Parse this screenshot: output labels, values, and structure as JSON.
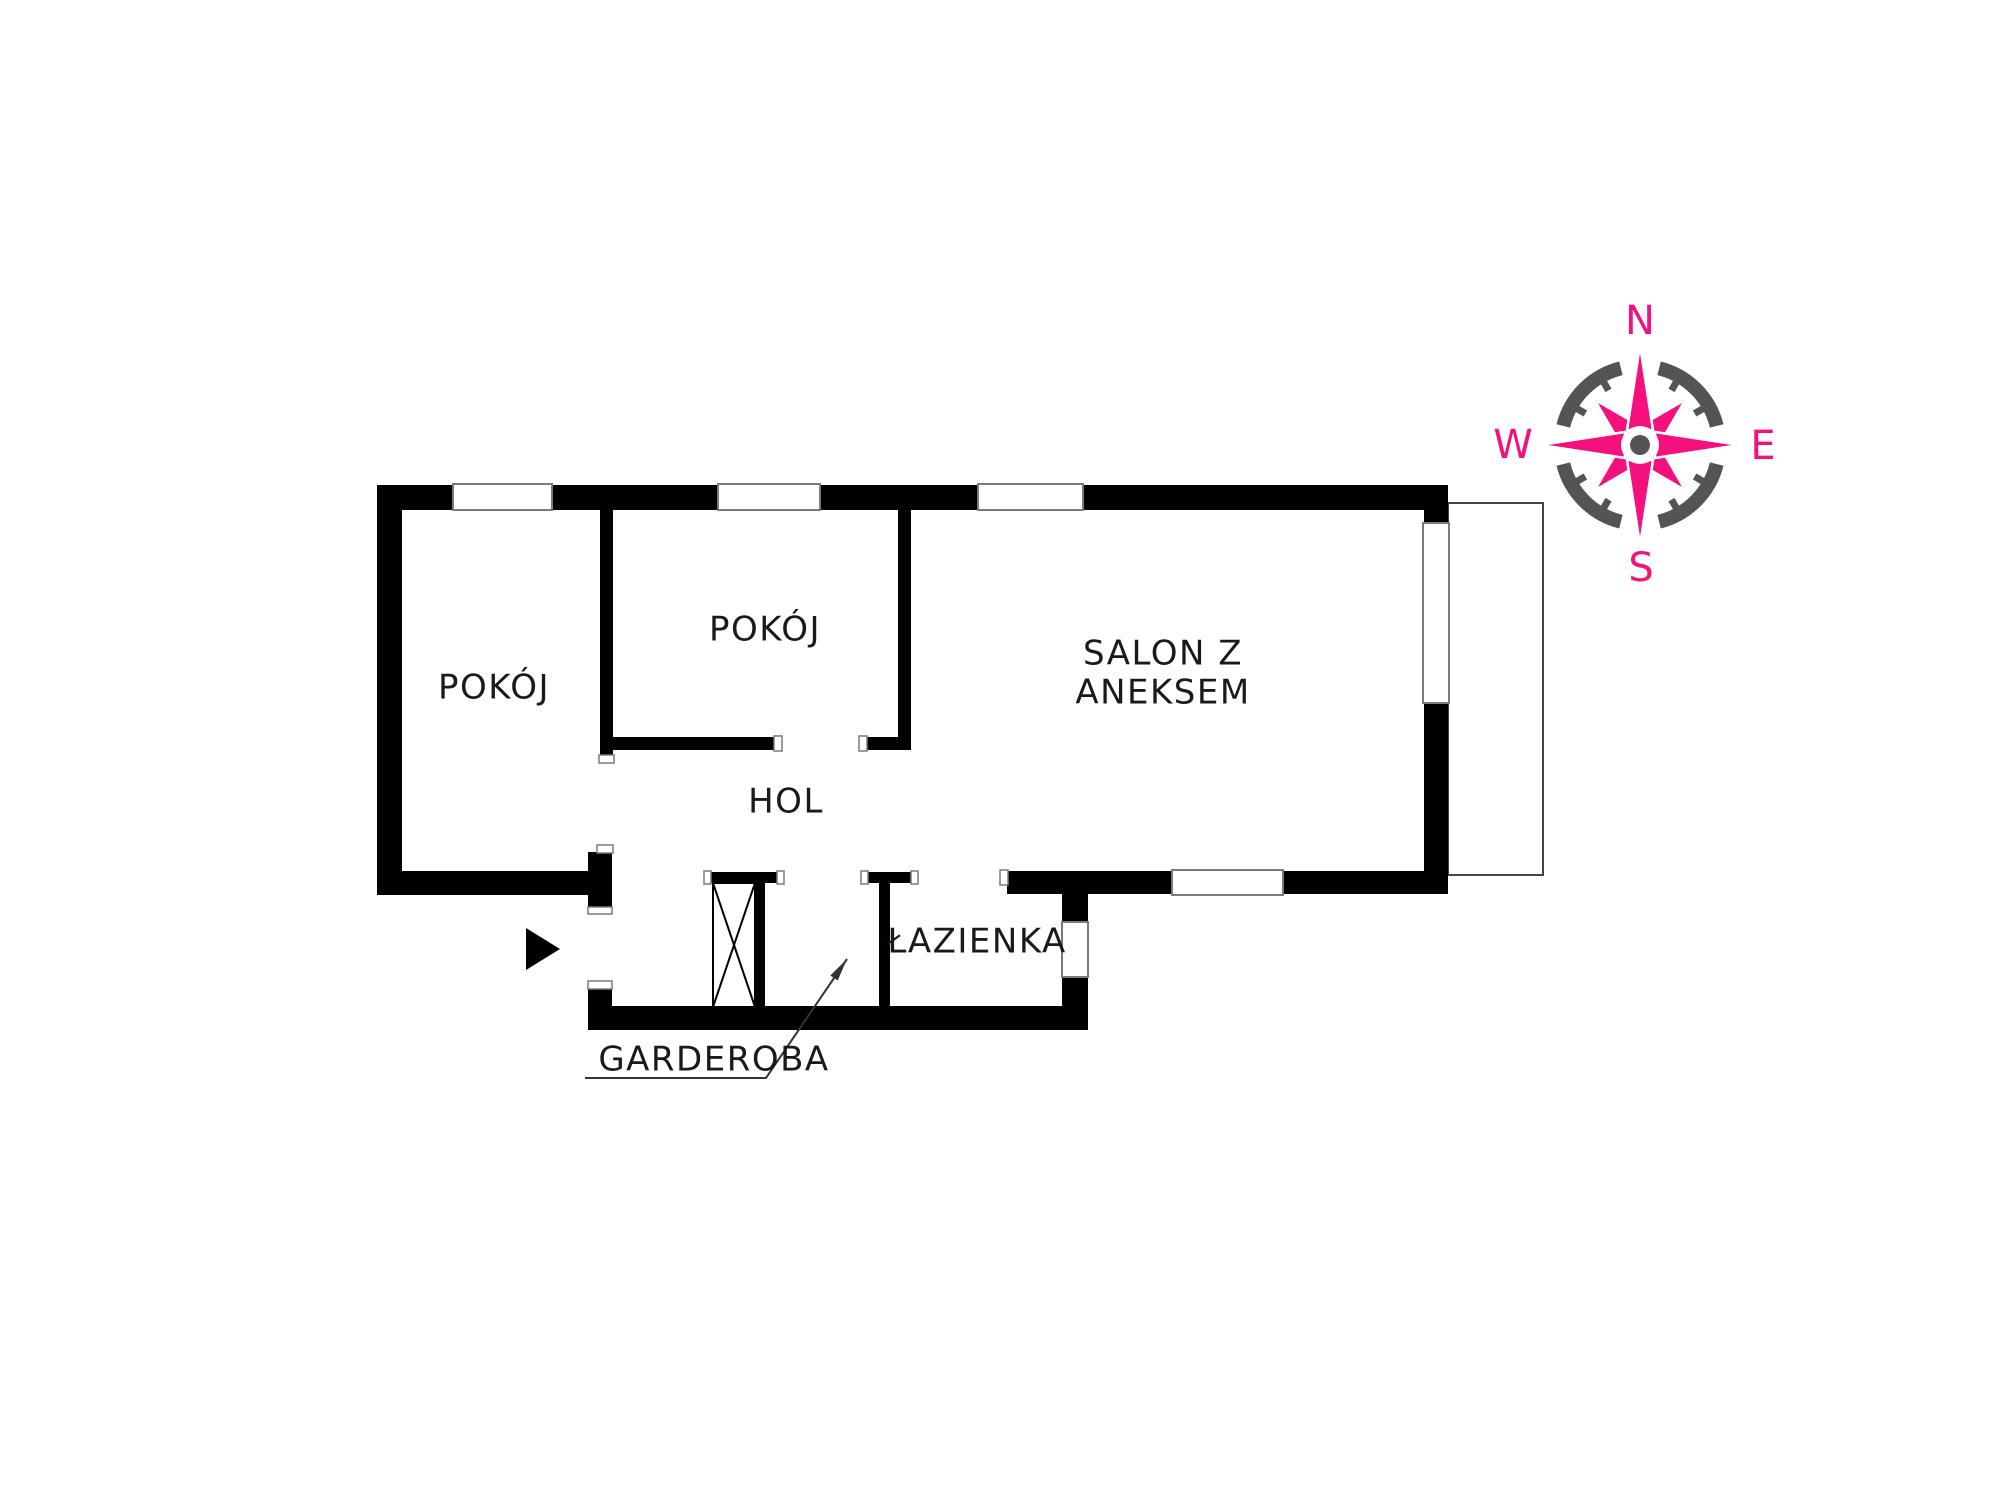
{
  "plan": {
    "type": "apartment-floor-plan",
    "rooms": [
      {
        "id": "pokoj-left",
        "label": "POKÓJ"
      },
      {
        "id": "pokoj-top",
        "label": "POKÓJ"
      },
      {
        "id": "salon",
        "label_line1": "SALON Z",
        "label_line2": "ANEKSEM"
      },
      {
        "id": "hol",
        "label": "HOL"
      },
      {
        "id": "lazienka",
        "label": "ŁAZIENKA"
      },
      {
        "id": "garderoba",
        "label": "GARDEROBA"
      }
    ],
    "symbols": [
      {
        "id": "entrance-arrow",
        "meaning": "entrance direction marker"
      },
      {
        "id": "wardrobe-box",
        "meaning": "built-in wardrobe (crossed rectangle)"
      },
      {
        "id": "balcony-outline",
        "meaning": "balcony / terrace thin outline"
      }
    ]
  },
  "compass": {
    "north": "N",
    "east": "E",
    "south": "S",
    "west": "W"
  },
  "colors": {
    "walls": "#000000",
    "background": "#FFFFFF",
    "thin_line": "#7A7A7A",
    "text": "#1A1A1A",
    "compass_accent": "#F5117D",
    "compass_ring": "#545457"
  }
}
